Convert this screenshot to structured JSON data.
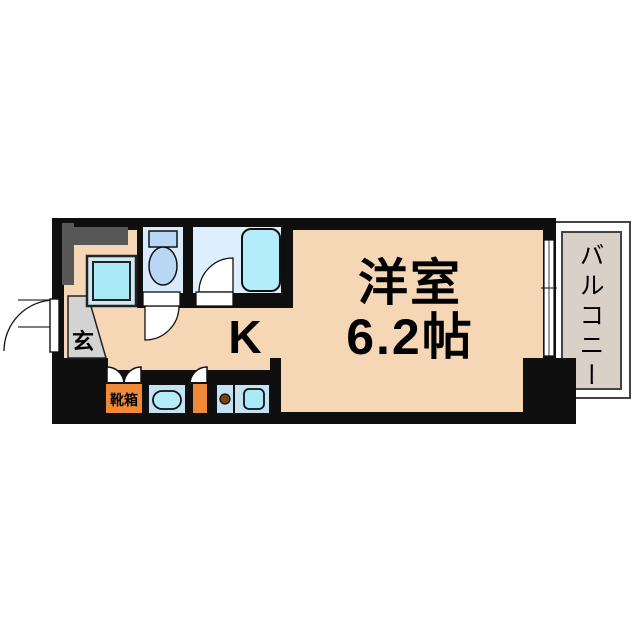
{
  "floor_plan": {
    "labels": {
      "room_name": "洋室",
      "room_size": "6.2帖",
      "kitchen": "K",
      "entrance": "玄",
      "shoe_box": "靴箱",
      "balcony": "バルコニー"
    },
    "colors": {
      "wall_black": "#0f0f0f",
      "floor_peach": "#f5d6b5",
      "wet_area_blue": "#d9eafc",
      "fixture_blue": "#c5e2f5",
      "appliance_cyan": "#a8eaf6",
      "tub_cyan": "#b4edfa",
      "toilet_blue": "#b8d7f4",
      "accent_orange": "#f08a38",
      "genkan_gray": "#d3d3d3",
      "shaft_gray": "#575757",
      "balcony_beige": "#d9d1c8",
      "burner_brown": "#7a4213"
    }
  }
}
